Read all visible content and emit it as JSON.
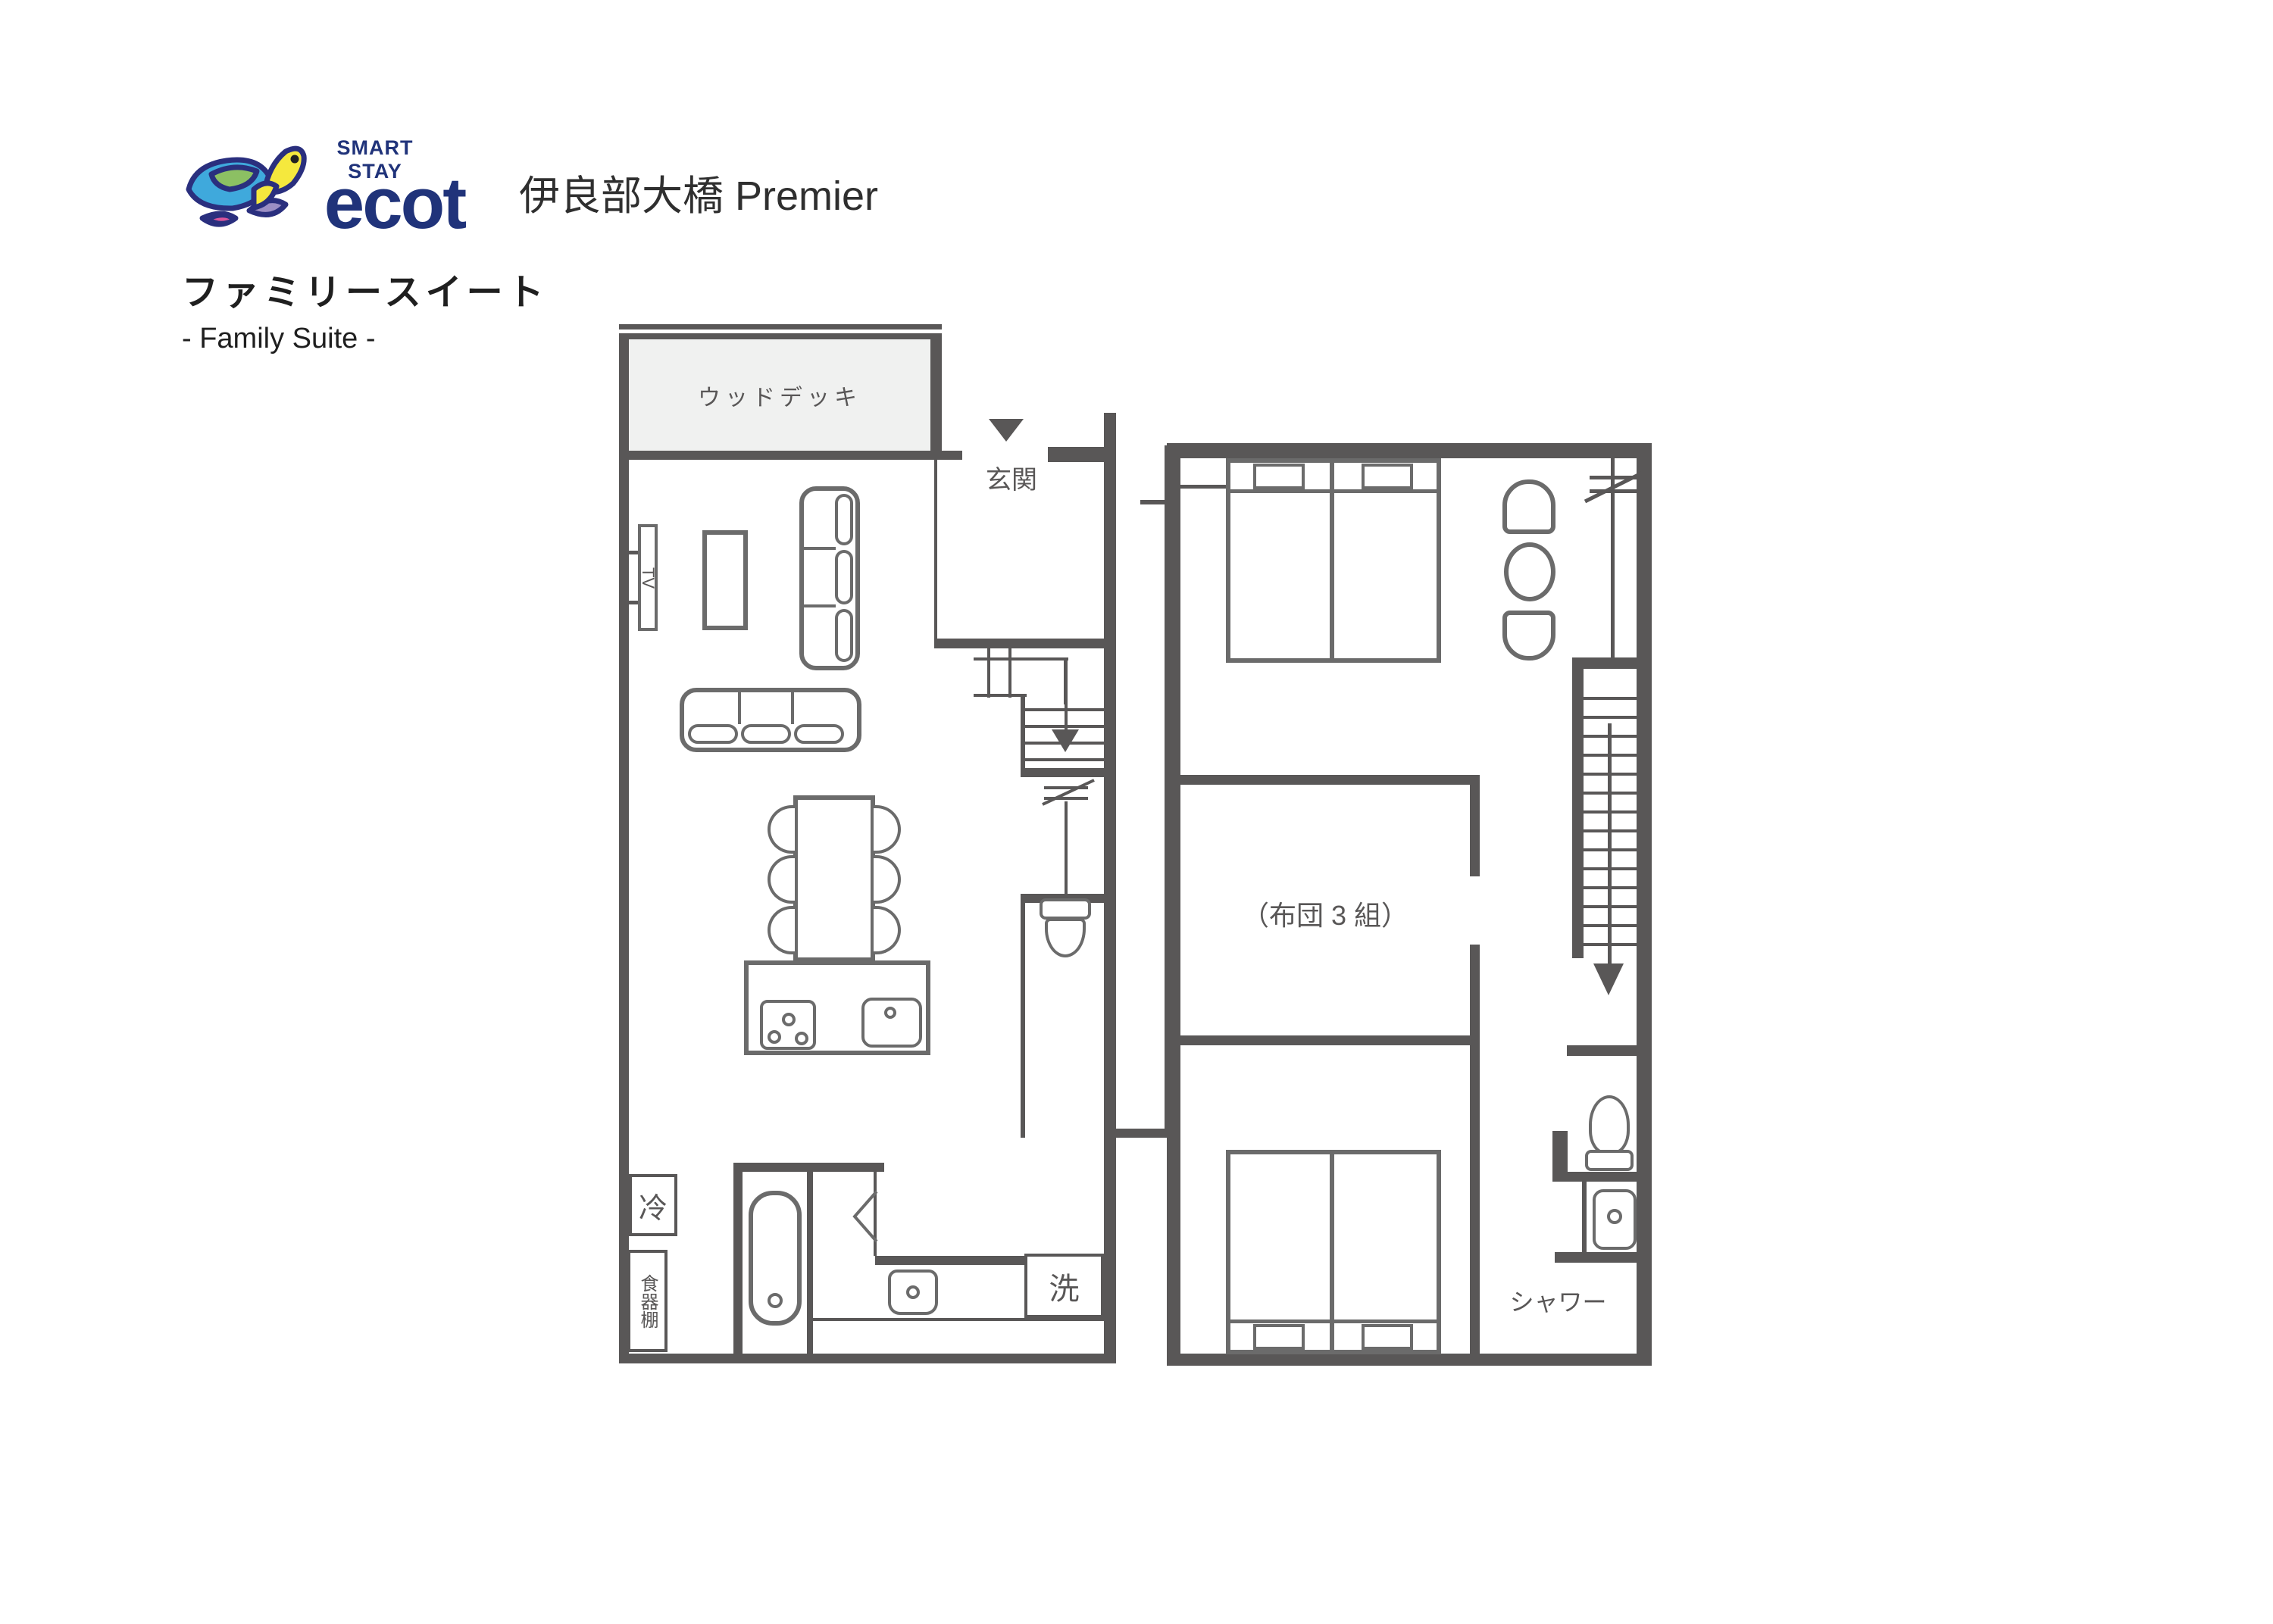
{
  "logo": {
    "smart_stay": "SMART STAY",
    "brand": "ecot",
    "navy": "#20337a"
  },
  "header": {
    "title": "伊良部大橋 Premier"
  },
  "heading": {
    "room_ja": "ファミリースイート",
    "room_en": "- Family Suite -"
  },
  "floor1": {
    "wood_deck": "ウッドデッキ",
    "entrance": "玄関",
    "tv": "TV",
    "fridge": "冷",
    "cupboard": "食器棚",
    "washer": "洗"
  },
  "floor2": {
    "futon": "（布団 3 組）",
    "shower": "シャワー"
  },
  "colors": {
    "wall": "#595757",
    "deck_fill": "#f0f1f0",
    "furniture_line": "#6b6b6b",
    "text": "#595757"
  }
}
